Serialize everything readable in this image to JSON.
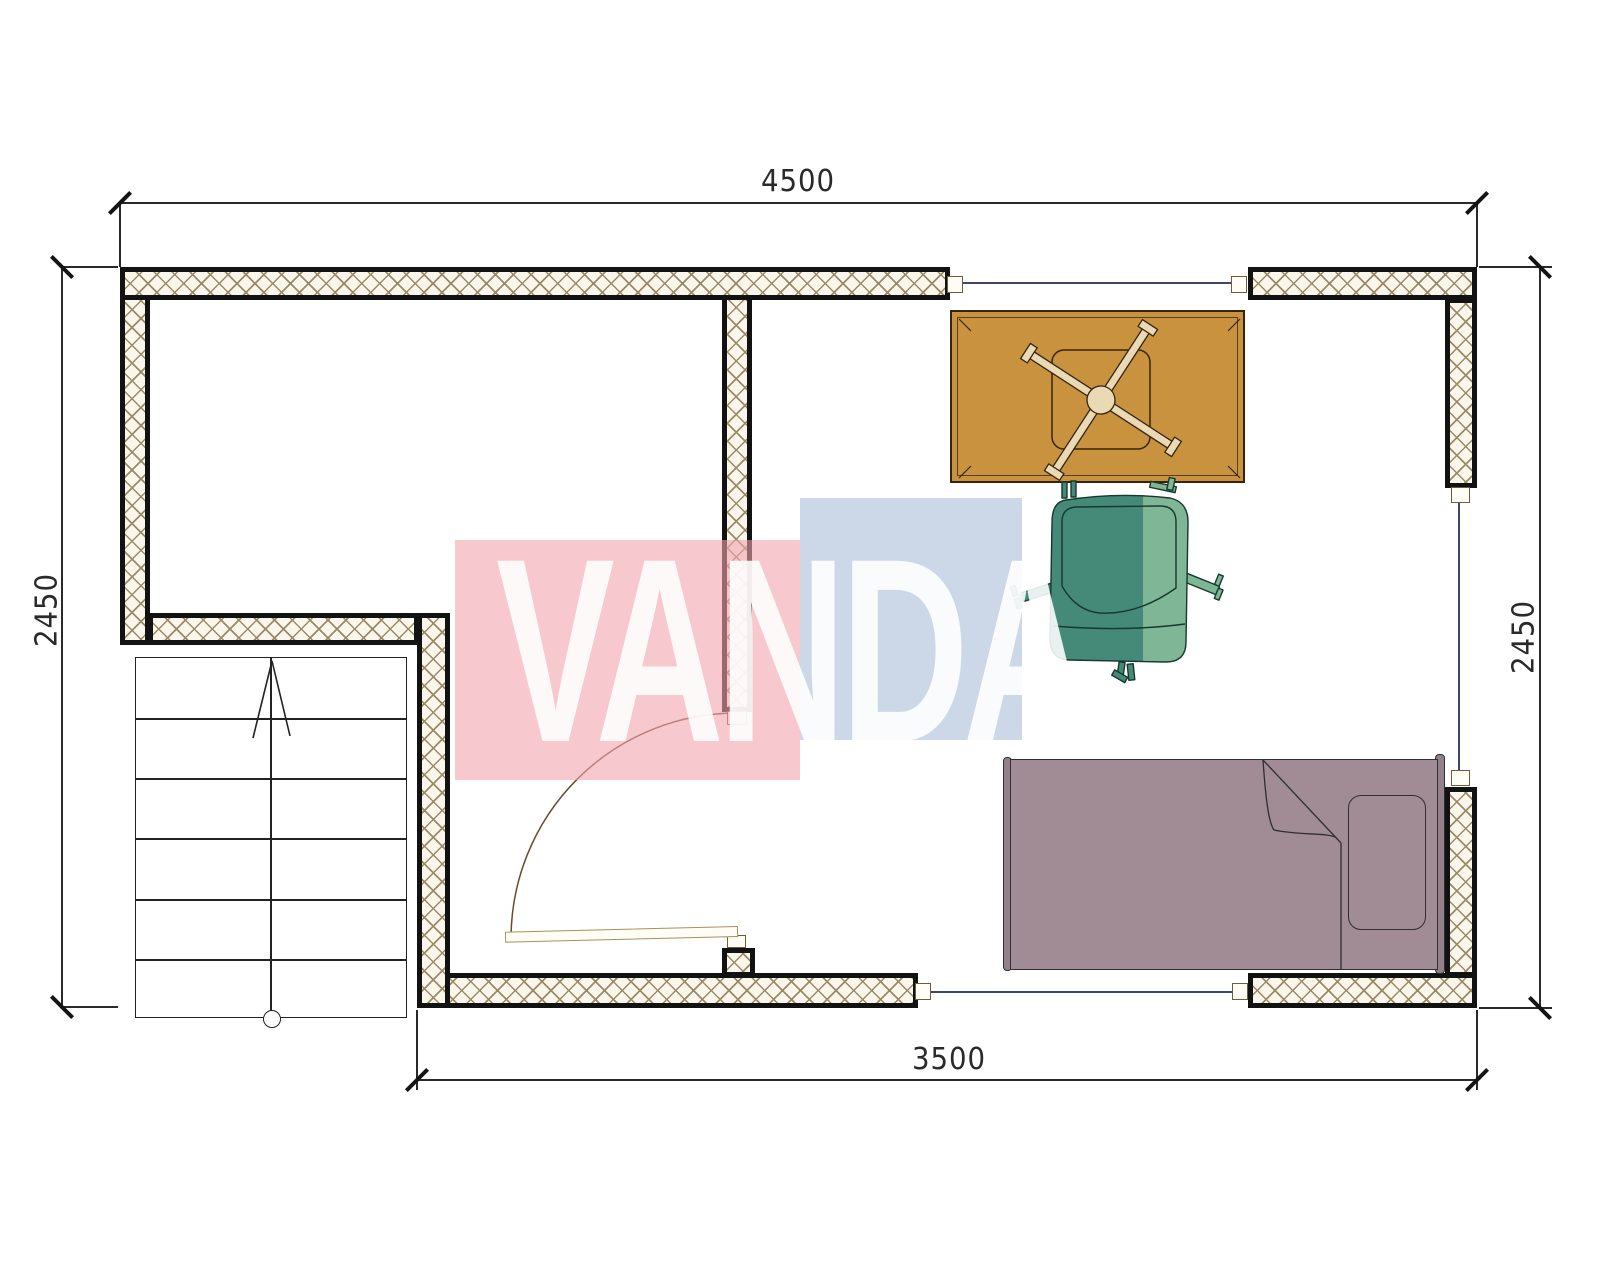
{
  "dimensions": {
    "top": "4500",
    "bottom": "3500",
    "left": "2450",
    "right": "2450"
  },
  "watermark": {
    "text": "VANDA"
  },
  "stairs": {
    "tread_count": 6,
    "direction": "up"
  },
  "furniture": {
    "table": "rectangular-table-with-cross-base",
    "chair": "armchair",
    "bed": "single-bed-with-pillow"
  },
  "colors": {
    "wall_fill": "#faf6ec",
    "hatch_line": "#9a8b66",
    "wall_border": "#121212",
    "line": "#2a2a2a",
    "window_line": "#3f4668",
    "marker_border": "#6b5d3f",
    "door": "#6b4a2e",
    "table_fill": "#c8923f",
    "table_stroke": "#35250c",
    "table_base_fill": "#ead9b5",
    "chair_dark": "#458a78",
    "chair_light": "#7eb696",
    "chair_stroke": "#17382e",
    "bed_fill": "#a18b95",
    "bed_stroke": "#2f2f2f",
    "pink_block": "rgba(242,165,173,0.6)",
    "blue_block": "rgba(170,190,215,0.6)",
    "watermark_text": "rgba(255,255,255,0.88)"
  }
}
